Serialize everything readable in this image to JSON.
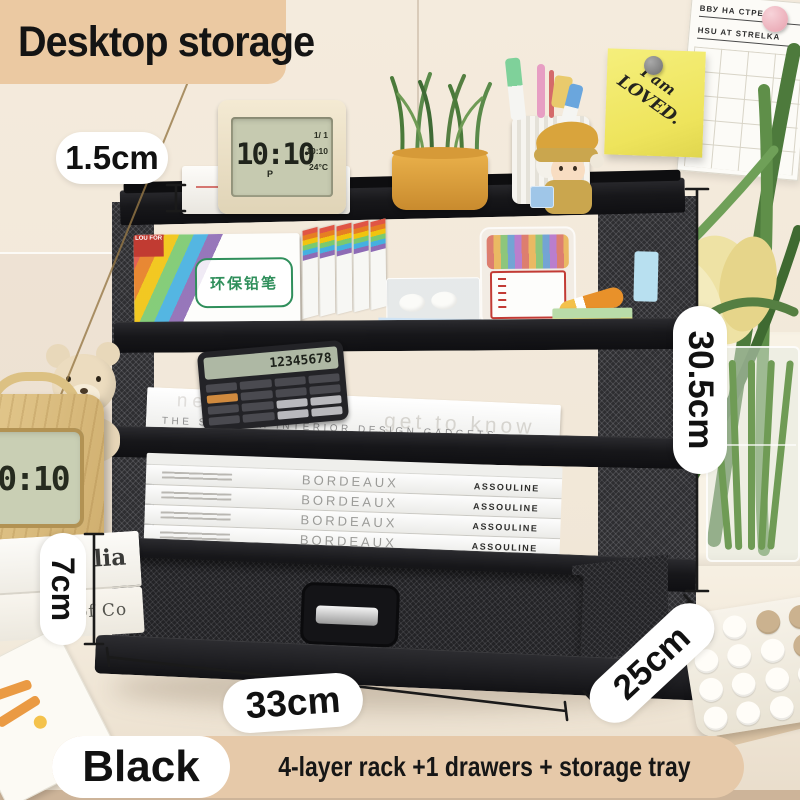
{
  "title": {
    "label": "Desktop storage"
  },
  "dims": {
    "lip": "1.5cm",
    "height": "30.5cm",
    "drawer": "7cm",
    "width": "33cm",
    "depth": "25cm"
  },
  "banner": {
    "color": "Black",
    "description": "4-layer rack +1 drawers + storage tray"
  },
  "sticky_note": {
    "line1": "I am",
    "line2": "LOVED."
  },
  "pinboard": {
    "row1": "ВВУ НА СТРЕЛКЕ",
    "row2": "HSU AT STRELKA"
  },
  "desk_clock": {
    "time": "10:10",
    "ampm": "P",
    "date": "1/ 1",
    "alarm": "10:10",
    "temp": "24°C"
  },
  "radio_clock": {
    "time": "10:10"
  },
  "calculator": {
    "display": "12345678"
  },
  "shelf_items": {
    "pencil_box_label": "环保铅笔",
    "pencil_box_brand": "LOU FOR",
    "magazine_spine": "THE SWEDISH INTERIOR DESIGN GADGETS",
    "magazine_faded_left": "neighbours",
    "magazine_faded_right": "get to know",
    "book_title": "BORDEAUX",
    "book_publisher": "ASSOULINE"
  },
  "left_books": {
    "top_spine": "lia",
    "bottom_spine": "of Co"
  },
  "colors": {
    "title_bg": "#ebc9a2",
    "banner_bg": "#e6c9a9",
    "rack_black": "#1c1c1f",
    "sticky_yellow": "#eee45c",
    "pot_orange": "#e0a33b"
  }
}
